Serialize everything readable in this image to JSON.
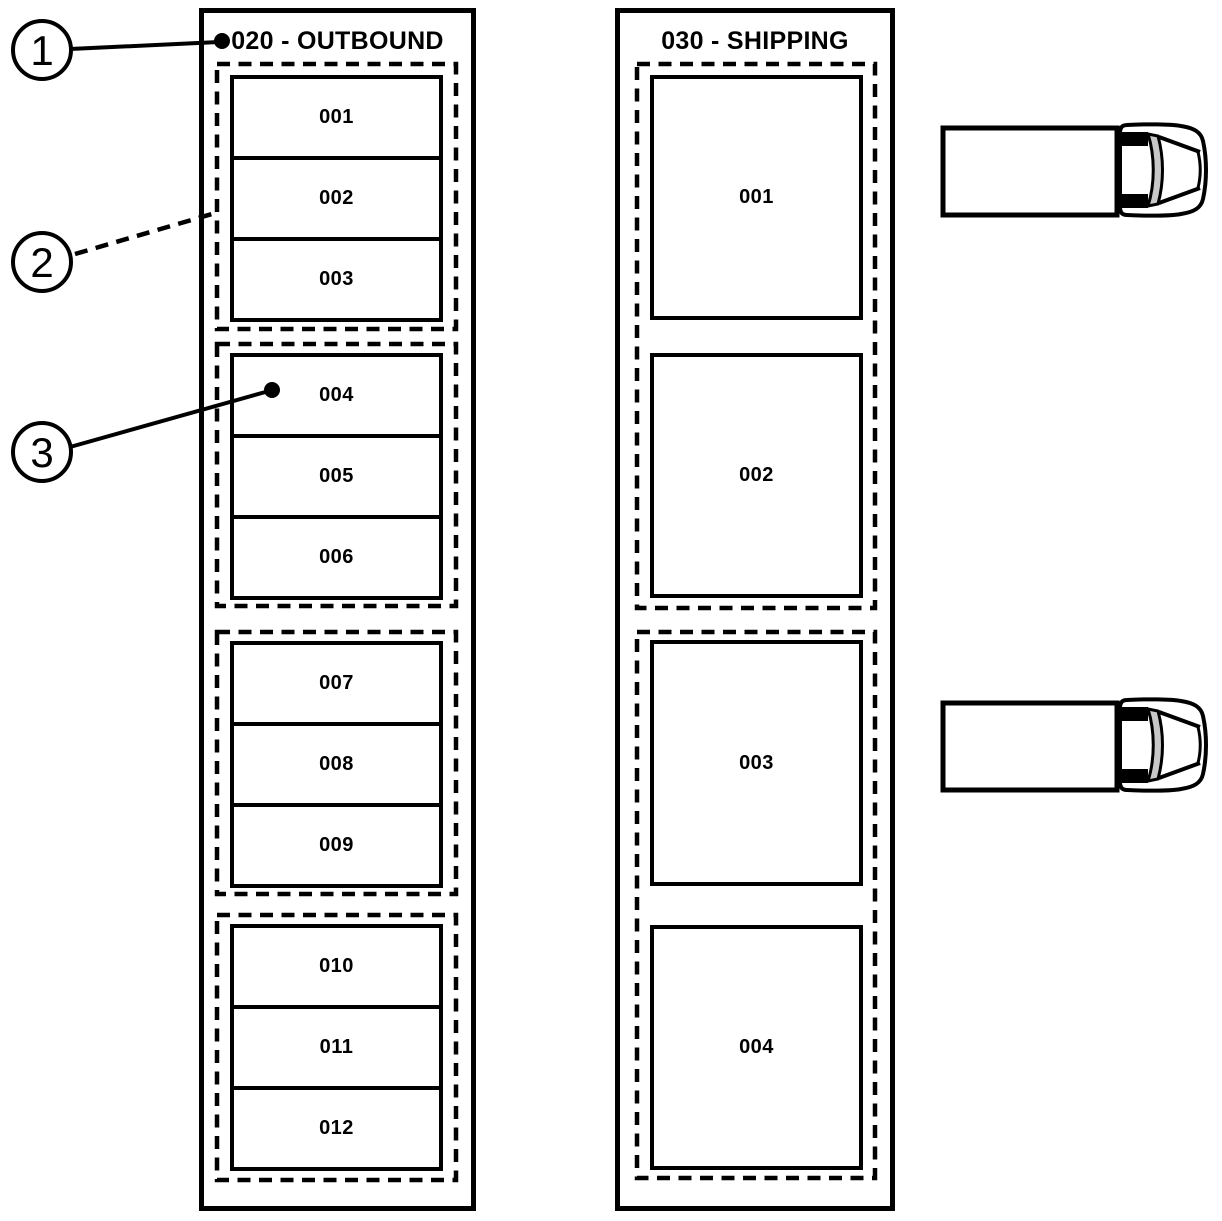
{
  "zones": [
    {
      "title": "020 - OUTBOUND",
      "groups": [
        {
          "slots": [
            "001",
            "002",
            "003"
          ]
        },
        {
          "slots": [
            "004",
            "005",
            "006"
          ]
        },
        {
          "slots": [
            "007",
            "008",
            "009"
          ]
        },
        {
          "slots": [
            "010",
            "011",
            "012"
          ]
        }
      ]
    },
    {
      "title": "030 - SHIPPING",
      "groups": [
        {
          "slots": [
            "001",
            "002"
          ]
        },
        {
          "slots": [
            "003",
            "004"
          ]
        }
      ]
    }
  ],
  "callouts": [
    {
      "label": "1",
      "leader_style": "solid",
      "points_to": "zone-title-020-outbound"
    },
    {
      "label": "2",
      "leader_style": "dashed",
      "points_to": "dashed-group-border"
    },
    {
      "label": "3",
      "leader_style": "solid",
      "points_to": "outbound-slot-004"
    }
  ],
  "icons": [
    {
      "name": "truck-icon-upper"
    },
    {
      "name": "truck-icon-lower"
    }
  ],
  "colors": {
    "line": "#000000",
    "background": "#ffffff",
    "truck_windshield": "#c8c8c8"
  }
}
